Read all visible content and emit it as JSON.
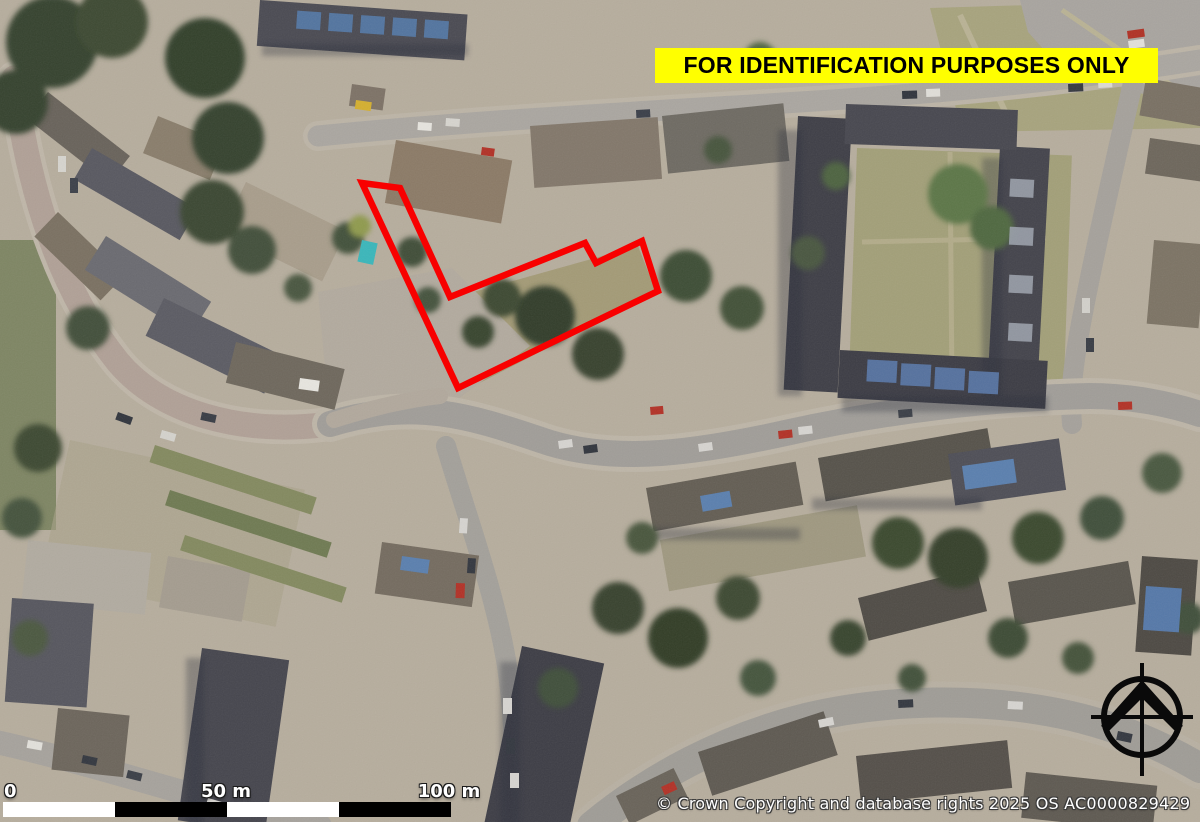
{
  "map": {
    "type": "aerial-photograph-site-plan",
    "disclaimer": "FOR IDENTIFICATION PURPOSES ONLY",
    "copyright": "© Crown Copyright and database rights 2025 OS AC0000829429",
    "scale_bar": {
      "labels": [
        "0",
        "50 m",
        "100 m"
      ],
      "total_m": 100,
      "segment_m": 25,
      "segment_width_px": 112,
      "segment_colors": [
        "#ffffff",
        "#000000",
        "#ffffff",
        "#000000"
      ]
    },
    "north_arrow_icon": "north-arrow-compass",
    "site_boundary": {
      "color": "#f80000",
      "stroke_width_px": 6.5,
      "points": "362,183 400,188 450,297 585,243 596,263 642,241 658,291 458,388"
    },
    "colors": {
      "banner_bg": "#ffff00",
      "banner_text": "#000000",
      "boundary": "#f80000",
      "scale_white": "#ffffff",
      "scale_black": "#000000",
      "label_text": "#ffffff",
      "north_arrow": "#0a0a0a"
    }
  }
}
